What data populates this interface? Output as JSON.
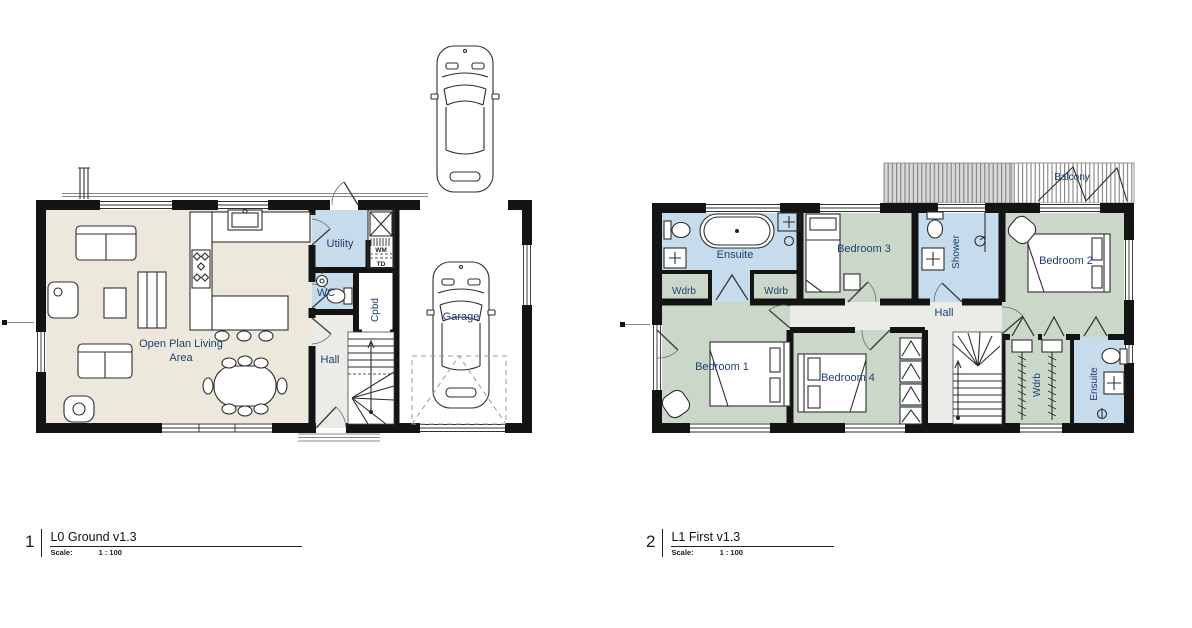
{
  "colors": {
    "wall": "#141414",
    "living_floor": "#ece9dc",
    "wetroom_floor": "#c6dbeb",
    "bedroom_floor": "#cbd8c9",
    "hall_floor": "#ebebe7",
    "balcony_gray": "#d8d8d8",
    "white": "#ffffff",
    "label_text": "#1d3f72"
  },
  "ground_floor": {
    "labels": {
      "open_plan_line1": "Open Plan Living",
      "open_plan_line2": "Area",
      "utility": "Utility",
      "wc": "WC",
      "cpbd": "Cpbd",
      "hall": "Hall",
      "garage": "Garage",
      "washing_machine": "WM",
      "tumble_dryer": "TD"
    },
    "title": {
      "number": "1",
      "name": "L0 Ground v1.3",
      "scale_label": "Scale:",
      "scale_value": "1 : 100"
    }
  },
  "first_floor": {
    "labels": {
      "ensuite_front": "Ensuite",
      "wdrb_front_left": "Wdrb",
      "wdrb_front_right": "Wdrb",
      "bedroom3": "Bedroom 3",
      "shower": "Shower",
      "bedroom2": "Bedroom 2",
      "hall": "Hall",
      "bedroom1": "Bedroom 1",
      "bedroom4": "Bedroom 4",
      "wdrb_rear": "Wdrb",
      "ensuite_rear": "Ensuite",
      "balcony": "Balcony"
    },
    "title": {
      "number": "2",
      "name": "L1 First v1.3",
      "scale_label": "Scale:",
      "scale_value": "1 : 100"
    }
  }
}
